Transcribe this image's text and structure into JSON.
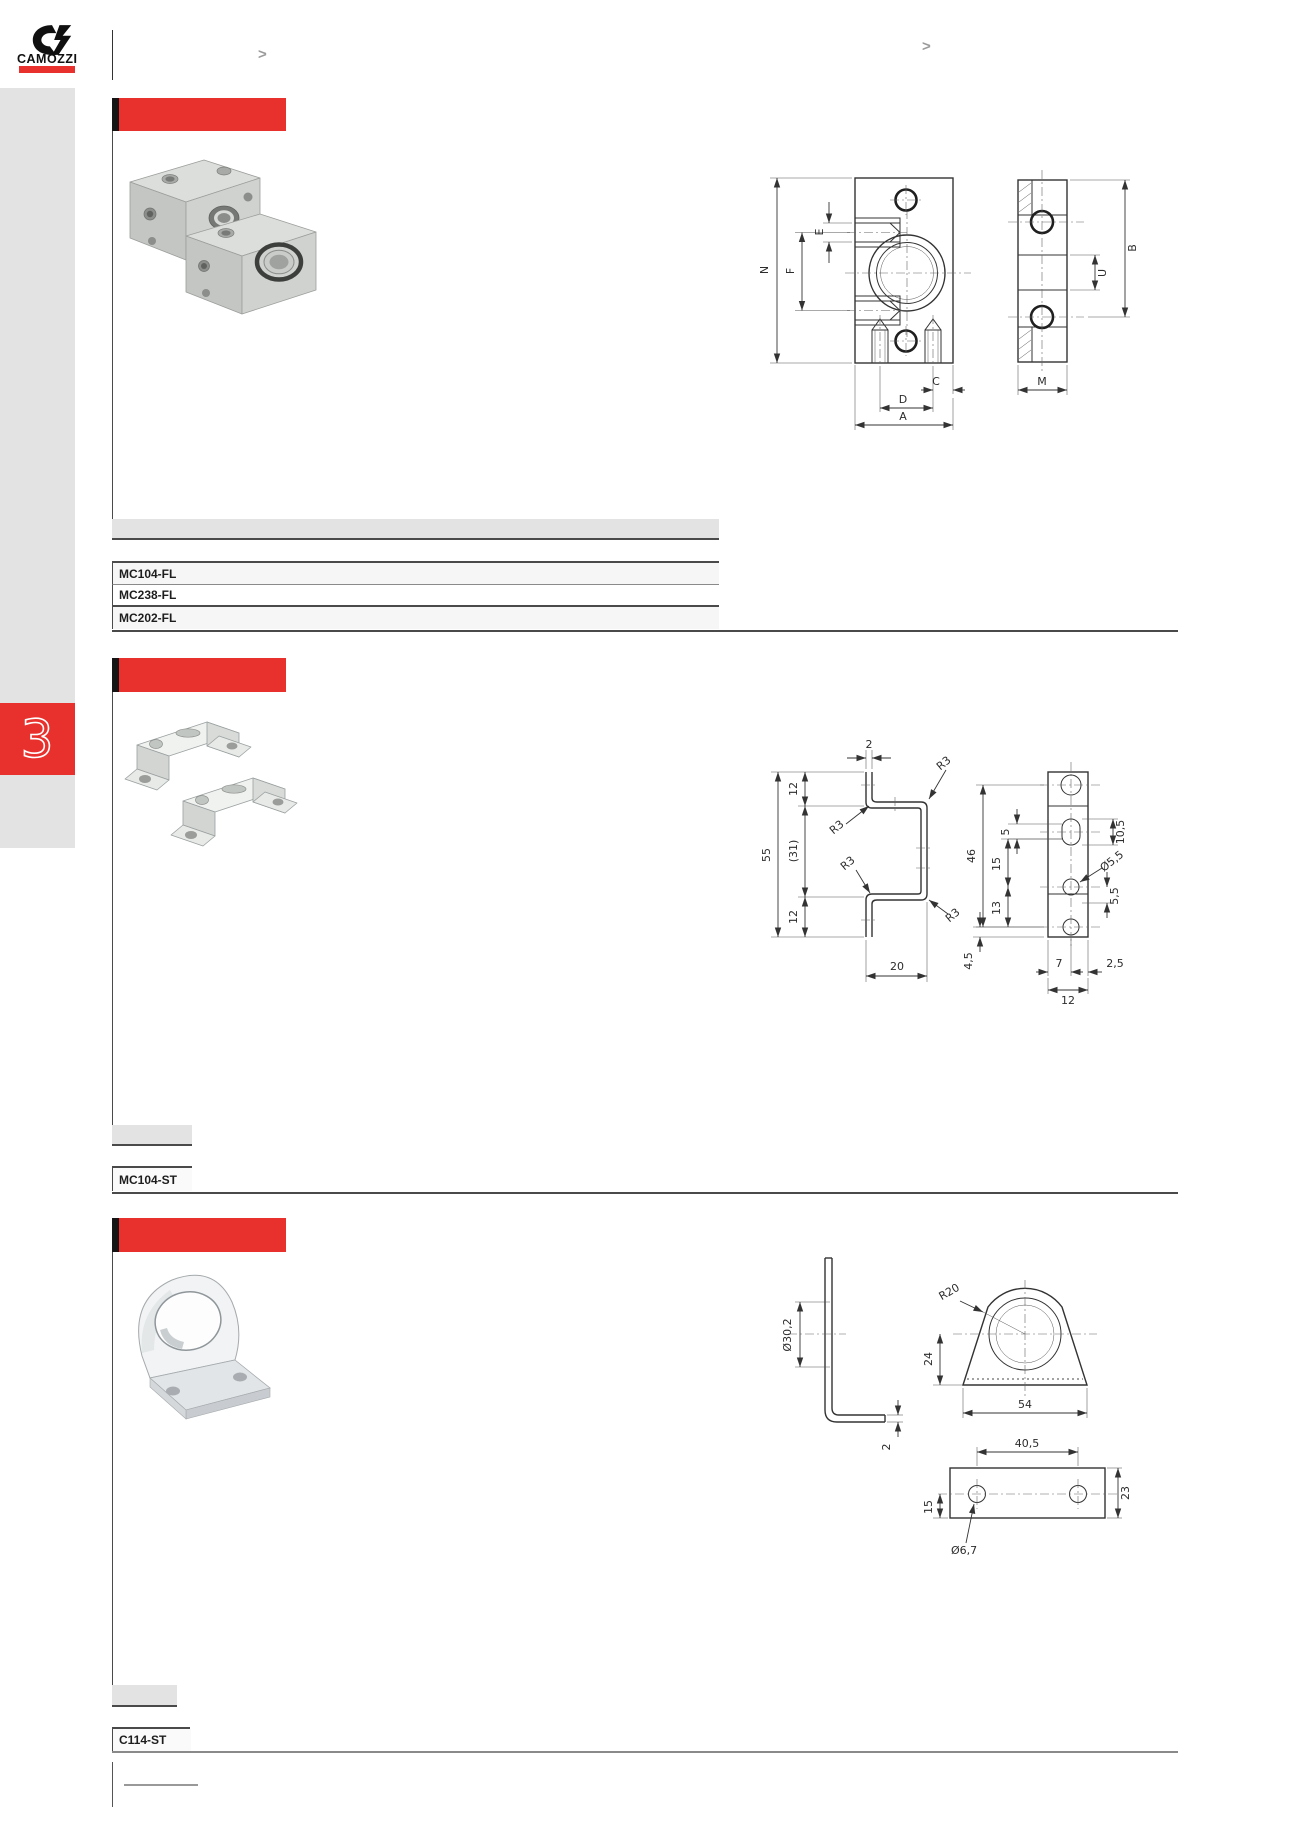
{
  "brand": {
    "name": "CAMOZZI"
  },
  "header": {
    "nav_left": ">",
    "nav_right": ">"
  },
  "sidebar": {
    "chapter": "3"
  },
  "sections": {
    "flange": {
      "title": "",
      "codes": [
        "MC104-FL",
        "MC238-FL",
        "MC202-FL"
      ],
      "dims": {
        "N": "N",
        "F": "F",
        "E": "E",
        "C": "C",
        "D": "D",
        "A": "A",
        "U": "U",
        "B": "B",
        "M": "M"
      }
    },
    "ubracket": {
      "title": "",
      "codes": [
        "MC104-ST"
      ],
      "dims": {
        "t2": "2",
        "h12t": "12",
        "h31": "(31)",
        "h55": "55",
        "h12b": "12",
        "w20": "20",
        "r3a": "R3",
        "r3b": "R3",
        "r3c": "R3",
        "r3d": "R3",
        "h46": "46",
        "g5": "5",
        "g15": "15",
        "g13": "13",
        "slot": "10,5",
        "dia": "Ø5,5",
        "e55": "5,5",
        "e45": "4,5",
        "b7": "7",
        "b25": "2,5",
        "b12": "12"
      }
    },
    "angle": {
      "title": "",
      "codes": [
        "C114-ST"
      ],
      "dims": {
        "d302": "Ø30,2",
        "t2": "2",
        "r20": "R20",
        "h24": "24",
        "w54": "54",
        "w405": "40,5",
        "h15": "15",
        "h23": "23",
        "d67": "Ø6,7"
      }
    }
  }
}
